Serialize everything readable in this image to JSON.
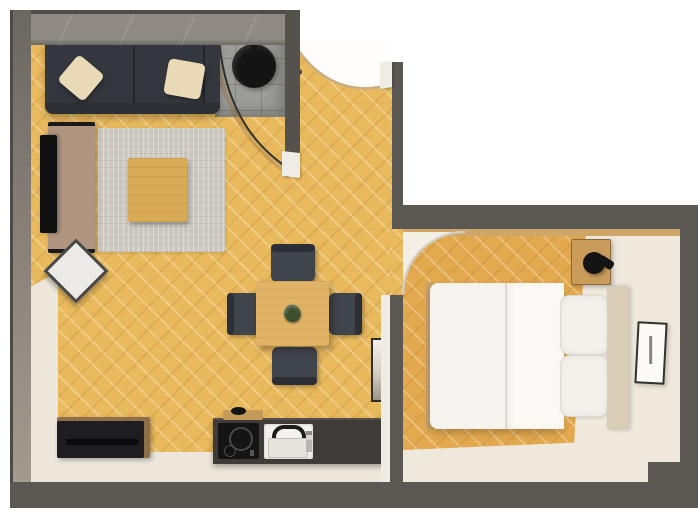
{
  "scene": {
    "label": "Top-down 3D rendered floor plan of a one-bedroom apartment",
    "view": "top-down render",
    "visible_text": "none"
  },
  "palette": {
    "wall_dark": "#5b5753",
    "wall_top_face": "#8f8b84",
    "wall_face_light": "#efece6",
    "floor_wood_living": "#e9b95d",
    "floor_wood_bedroom": "#e2a94f",
    "floor_cream": "#ece6db",
    "tile_gray": "#9c9c98",
    "rug": "#cdc9c1",
    "sofa": "#34373d",
    "pillow_cream": "#ead9b6",
    "wood_furniture": "#d9ab56",
    "chair_dark": "#40444b",
    "counter_dark": "#3f3b38",
    "appliance_black": "#141414",
    "sink_white": "#f3f2ef",
    "bedding_white": "#f6f4f0",
    "headboard_beige": "#d9cdb7",
    "cabinet_black": "#1e1e21",
    "console_wood": "#b09681"
  },
  "rooms": {
    "living": {
      "label": "Living room with dining area and kitchenette, herringbone wood floor"
    },
    "entry": {
      "label": "Entry with open door swing and corner shower area"
    },
    "bedroom": {
      "label": "Bedroom with double bed"
    }
  },
  "objects": {
    "sofa": {
      "label": "Dark gray sofa with two cream pillows"
    },
    "rug": {
      "label": "Light gray area rug"
    },
    "coffee_table": {
      "label": "Square wooden coffee table"
    },
    "tv_console": {
      "label": "Wooden TV console"
    },
    "tv": {
      "label": "Flat screen TV"
    },
    "side_stool": {
      "label": "White square side stool (rotated)"
    },
    "shower": {
      "label": "Corner shower with round black basin and curved glass screen"
    },
    "dining_table": {
      "label": "Square wooden dining table with plant"
    },
    "dining_chairs": {
      "label": "Four dark dining chairs"
    },
    "kitchen_counter": {
      "label": "Dark kitchen counter with cooktop and sink"
    },
    "cooktop": {
      "label": "Black induction cooktop"
    },
    "sink": {
      "label": "White kitchen sink with black faucet"
    },
    "cutting_board": {
      "label": "Wooden cutting board"
    },
    "cabinet": {
      "label": "Low black sideboard cabinet"
    },
    "entrance_door": {
      "label": "Entrance door swing (open)"
    },
    "bedroom_door": {
      "label": "Bedroom door swing (open)"
    },
    "bed": {
      "label": "Double bed with white duvet and two pillows"
    },
    "headboard": {
      "label": "Beige headboard"
    },
    "nightstand": {
      "label": "Wooden nightstand with black lamp"
    },
    "picture_frame": {
      "label": "Leaning picture frame"
    },
    "mirror": {
      "label": "Leaning mirror on dividing wall"
    }
  }
}
